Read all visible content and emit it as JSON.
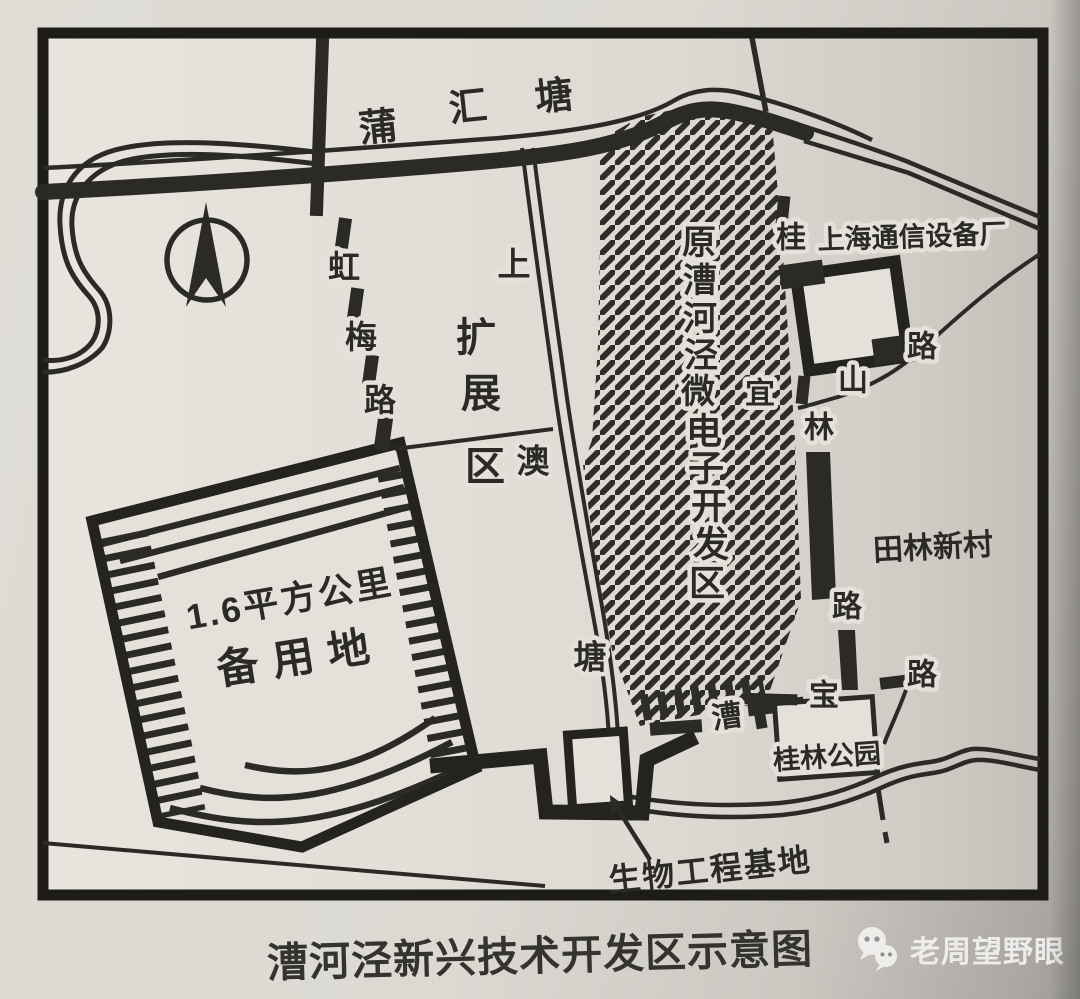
{
  "caption": "漕河泾新兴技术开发区示意图",
  "watermark": {
    "text": "老周望野眼",
    "icon": "wechat-bubbles-icon"
  },
  "map": {
    "colors": {
      "ink": "#2b2a26",
      "paper": "#e4e1da",
      "page_shadow": "#9b9995"
    },
    "compass": "north-arrow",
    "rivers": {
      "puhuitang": {
        "chars": [
          "蒲",
          "汇",
          "塘"
        ]
      },
      "shangaotang": {
        "chars": [
          "上",
          "澳",
          "塘"
        ]
      }
    },
    "roads": {
      "hongmeilu": {
        "chars": [
          "虹",
          "梅",
          "路"
        ]
      },
      "guilinlu": {
        "chars": [
          "桂",
          "林",
          "路"
        ]
      },
      "yishanlu": {
        "chars": [
          "宜",
          "山",
          "路"
        ]
      },
      "caobaolu": {
        "chars": [
          "漕",
          "宝",
          "路"
        ]
      }
    },
    "zones": {
      "expansion": {
        "chars": [
          "扩",
          "展",
          "区"
        ]
      },
      "micro_zone": {
        "chars": [
          "原",
          "漕",
          "河",
          "泾",
          "微",
          "电",
          "子",
          "开",
          "发",
          "区"
        ]
      },
      "reserve": {
        "area_line": "1.6平方公里",
        "name_line": "备用地"
      },
      "factory": {
        "label": "上海通信设备厂"
      },
      "tianlin": {
        "label": "田林新村"
      },
      "park": {
        "label": "桂林公园"
      },
      "bio_base": {
        "label": "生物工程基地"
      }
    }
  }
}
